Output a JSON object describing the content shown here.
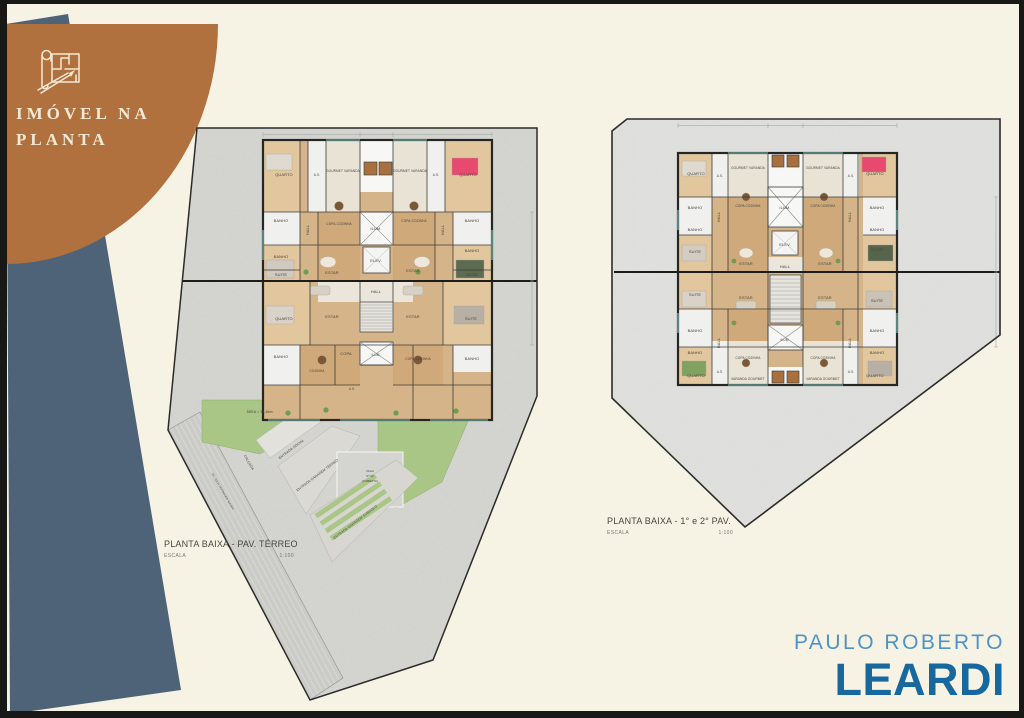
{
  "badge": {
    "icon": "blueprint-plan-icon",
    "line1": "IMÓVEL NA",
    "line2": "PLANTA"
  },
  "plans": {
    "left": {
      "title": "PLANTA BAIXA - PAV. TÉRREO",
      "scale_label": "ESCALA",
      "scale_value": "1:100",
      "rooms": [
        "QUARTO",
        "A.S.",
        "GOURMET VARANDA",
        "GOURMET VARANDA",
        "A.S.",
        "QUARTO",
        "BANHO",
        "BANHO",
        "HALL",
        "COPA-COZINHA",
        "ILUM.",
        "COPA-COZINHA",
        "HALL",
        "BANHO",
        "BANHO",
        "SUITE",
        "ESTAR",
        "ELEV.",
        "ESTAR",
        "SUITE",
        "HALL",
        "QUARTO",
        "ESTAR",
        "ESTAR",
        "SUITE",
        "BANHO",
        "COZINHA",
        "COPA",
        "ILUM.",
        "COPA-COZINHA",
        "BANHO",
        "A.S."
      ],
      "site": {
        "area": "ÁREA = 23,46m²",
        "entrada_social": "ENTRADA SOCIAL",
        "entrada_garagem_terreo": "ENTRADA GARAGEM TÉRREO",
        "vaga": [
          "VAGA",
          "Nº 02",
          "(COBERTA)"
        ],
        "entrada_garagem_subsolo": "ENTRADA GARAGEM SUBSOLO",
        "calcada": "CALÇADA",
        "street": "AV. JULIA HOFBAUER MAYER"
      }
    },
    "right": {
      "title": "PLANTA BAIXA - 1° e 2° PAV.",
      "scale_label": "ESCALA",
      "scale_value": "1:100",
      "rooms": [
        "QUARTO",
        "A.S.",
        "GOURMET VARANDA",
        "GOURMET VARANDA",
        "A.S.",
        "QUARTO",
        "BANHO",
        "BANHO",
        "HALL",
        "COPA COZINHA",
        "ILUM.",
        "COPA COZINHA",
        "HALL",
        "BANHO",
        "BANHO",
        "SUITE",
        "ESTAR",
        "ELEV.",
        "ESTAR",
        "SUITE",
        "HALL",
        "SUITE",
        "ESTAR",
        "ESTAR",
        "SUITE",
        "BANHO",
        "BANHO",
        "HALL",
        "COPA COZINHA",
        "ILUM.",
        "COPA COZINHA",
        "HALL",
        "BANHO",
        "BANHO",
        "QUARTO",
        "A.S.",
        "VARANDA GOURMET",
        "VARANDA GOURMET",
        "A.S.",
        "QUARTO"
      ]
    }
  },
  "logo": {
    "line1": "PAULO ROBERTO",
    "line2": "LEARDI"
  },
  "colors": {
    "background": "#f6f3e5",
    "badge_brown": "#b1713e",
    "badge_slate": "#4e6377",
    "badge_text": "#f2ead6",
    "logo_light": "#4e92c8",
    "logo_dark": "#17689e",
    "plot_gray_left": "#d6d6d2",
    "plot_gray_right": "#e1e1df",
    "garden_green": "#a9c687",
    "floor_wood": "#d5b489",
    "accent_pink": "#e8496f",
    "accent_cyan": "#7fd0c9"
  }
}
